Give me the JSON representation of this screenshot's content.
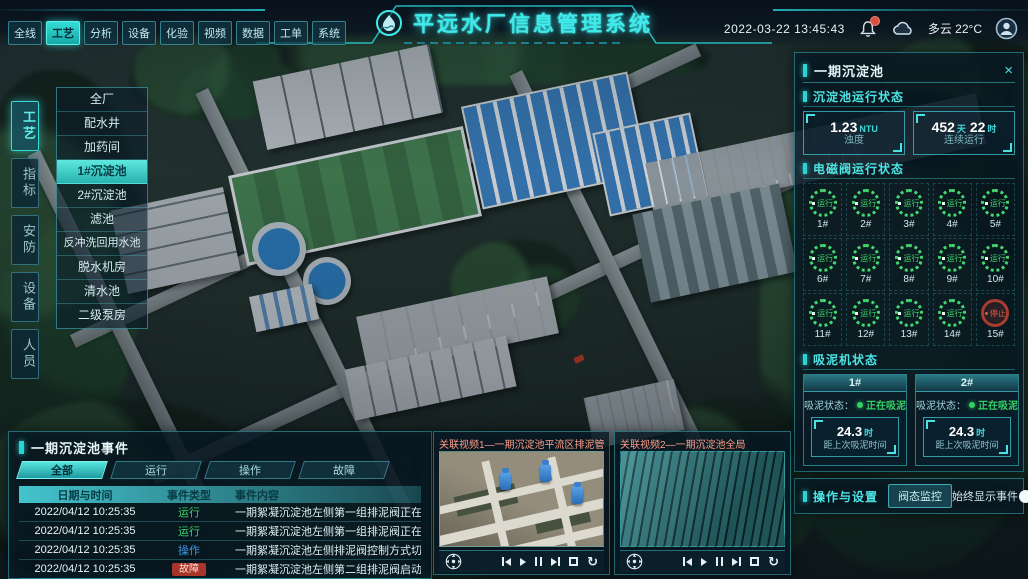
{
  "top_nav": {
    "tabs": [
      "全线",
      "工艺",
      "分析",
      "设备",
      "化验",
      "视频",
      "数据",
      "工单",
      "系统"
    ],
    "active_tab": "工艺",
    "title": "平远水厂信息管理系统",
    "datetime": "2022-03-22 13:45:43",
    "weather": "多云 22°C",
    "icons": {
      "bell": "notification bell with red alert badge",
      "cloud": "weather cloud",
      "avatar": "user profile"
    }
  },
  "left_nav": {
    "tabs": [
      "工艺",
      "指标",
      "安防",
      "设备",
      "人员"
    ],
    "active_tab": "工艺",
    "submenu": [
      "全厂",
      "配水井",
      "加药间",
      "1#沉淀池",
      "2#沉淀池",
      "滤池",
      "反冲洗回用水池",
      "脱水机房",
      "清水池",
      "二级泵房"
    ],
    "active_submenu": "1#沉淀池"
  },
  "right_panel": {
    "title": "一期沉淀池",
    "close": "×",
    "run_status": {
      "title": "沉淀池运行状态",
      "turbidity": {
        "value": "1.23",
        "unit": "NTU",
        "label": "浊度"
      },
      "runtime": {
        "value_days": "452",
        "unit_days": "天",
        "value_hours": "22",
        "unit_hours": "时",
        "label": "连续运行"
      }
    },
    "valves": {
      "title": "电磁阀运行状态",
      "items": [
        {
          "id": "1#",
          "status": "运行",
          "state": "run"
        },
        {
          "id": "2#",
          "status": "运行",
          "state": "run"
        },
        {
          "id": "3#",
          "status": "运行",
          "state": "run"
        },
        {
          "id": "4#",
          "status": "运行",
          "state": "run"
        },
        {
          "id": "5#",
          "status": "运行",
          "state": "run"
        },
        {
          "id": "6#",
          "status": "运行",
          "state": "run"
        },
        {
          "id": "7#",
          "status": "运行",
          "state": "run"
        },
        {
          "id": "8#",
          "status": "运行",
          "state": "run"
        },
        {
          "id": "9#",
          "status": "运行",
          "state": "run"
        },
        {
          "id": "10#",
          "status": "运行",
          "state": "run"
        },
        {
          "id": "11#",
          "status": "运行",
          "state": "run"
        },
        {
          "id": "12#",
          "status": "运行",
          "state": "run"
        },
        {
          "id": "13#",
          "status": "运行",
          "state": "run"
        },
        {
          "id": "14#",
          "status": "运行",
          "state": "run"
        },
        {
          "id": "15#",
          "status": "停止",
          "state": "stop"
        }
      ]
    },
    "mud_suction": {
      "title": "吸泥机状态",
      "machines": [
        {
          "id": "1#",
          "status_label": "吸泥状态：",
          "status": "正在吸泥",
          "value": "24.3",
          "unit": "时",
          "label": "距上次吸泥时间"
        },
        {
          "id": "2#",
          "status_label": "吸泥状态：",
          "status": "正在吸泥",
          "value": "24.3",
          "unit": "时",
          "label": "距上次吸泥时间"
        }
      ]
    },
    "operations": {
      "title": "操作与设置",
      "monitor_button": "阀态监控",
      "toggle_label": "始终显示事件：",
      "toggle_state": "on"
    }
  },
  "events_panel": {
    "title": "一期沉淀池事件",
    "tabs": [
      "全部",
      "运行",
      "操作",
      "故障"
    ],
    "active_tab": "全部",
    "columns": [
      "日期与时间",
      "事件类型",
      "事件内容"
    ],
    "rows": [
      {
        "datetime": "2022/04/12 10:25:35",
        "type": "运行",
        "type_class": "run",
        "content": "一期絮凝沉淀池左侧第一组排泥阀正在排泥"
      },
      {
        "datetime": "2022/04/12 10:25:35",
        "type": "运行",
        "type_class": "run",
        "content": "一期絮凝沉淀池左侧第一组排泥阀正在排泥"
      },
      {
        "datetime": "2022/04/12 10:25:35",
        "type": "操作",
        "type_class": "op",
        "content": "一期絮凝沉淀池左侧排泥阀控制方式切换为手动"
      },
      {
        "datetime": "2022/04/12 10:25:35",
        "type": "故障",
        "type_class": "fault",
        "content": "一期絮凝沉淀池左侧第二组排泥阀启动失败"
      }
    ]
  },
  "videos": [
    {
      "title": "关联视频1—一期沉淀池平流区排泥管廊"
    },
    {
      "title": "关联视频2—一期沉淀池全局"
    }
  ],
  "icons_legend": {
    "ptz": "pan-tilt-zoom pad",
    "prev": "skip back",
    "play": "play",
    "pause": "pause",
    "next": "skip forward",
    "fullscreen": "fullscreen",
    "loop": "replay"
  }
}
